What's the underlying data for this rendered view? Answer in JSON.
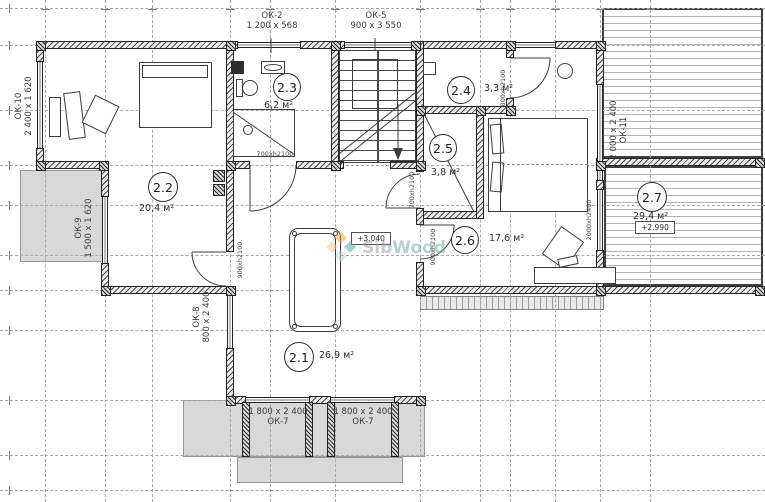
{
  "watermark": {
    "part1": "Sib",
    "part2": "Wood"
  },
  "rooms": [
    {
      "number": "2.1",
      "area": "26,9 м²"
    },
    {
      "number": "2.2",
      "area": "20,4 м²"
    },
    {
      "number": "2.3",
      "area": "6,2 м²"
    },
    {
      "number": "2.4",
      "area": "3,3 м²"
    },
    {
      "number": "2.5",
      "area": "3,8 м²"
    },
    {
      "number": "2.6",
      "area": "17,6 м²"
    },
    {
      "number": "2.7",
      "area": "29,4 м²"
    }
  ],
  "windows": {
    "ok2": {
      "name": "ОК-2",
      "size": "1 200 x 568"
    },
    "ok5": {
      "name": "ОК-5",
      "size": "900 x 3 550"
    },
    "ok7a": {
      "name": "ОК-7",
      "size": "1 800 x 2 400"
    },
    "ok7b": {
      "name": "ОК-7",
      "size": "1 800 x 2 400"
    },
    "ok8": {
      "name": "ОК-8",
      "size": "800 x 2 400"
    },
    "ok9": {
      "name": "ОК-9",
      "size": "1 500 x 1 620"
    },
    "ok10": {
      "name": "ОК-10",
      "size": "2 400 x 1 620"
    },
    "ok11": {
      "name": "ОК-11",
      "size": "2 000 x 2 400"
    }
  },
  "doors": {
    "bath": "700xh2100",
    "closet": "700xh2100",
    "room22": "900xh2100",
    "room26": "900xh2100",
    "dressing": "800xh2100",
    "terrace": "2000xh2400"
  },
  "elevations": {
    "hall": "+3.040",
    "terrace": "+2.990"
  }
}
